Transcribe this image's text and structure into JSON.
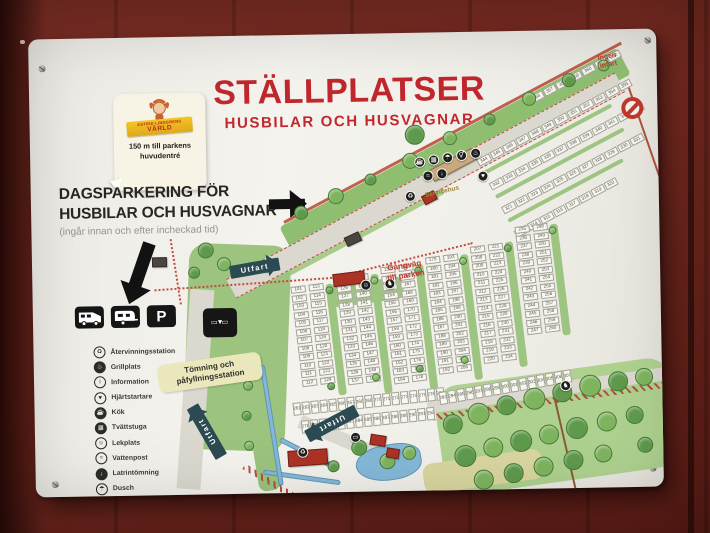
{
  "scene": {
    "setting": "white map sign mounted on red wooden wall"
  },
  "colors": {
    "wall": "#7a2b22",
    "board": "#f0efe9",
    "title_red": "#c1272d",
    "map_green": "#8fbe71",
    "lawn_green": "#9cc47e",
    "forest_green": "#aed18f",
    "tree_dark": "#5f9a4c",
    "tree_light": "#7fb45f",
    "road": "#dbd8cf",
    "teal_arrow": "#2c4a52",
    "label_yellow": "#ebe7bd",
    "path_red": "#c24b3f",
    "building_red": "#ad3326",
    "building_tan": "#c9a97e",
    "building_dark": "#4a453f",
    "water": "#85b8d8",
    "fence_brown": "#b05040"
  },
  "sign": {
    "title": "STÄLLPLATSER",
    "subtitle": "HUSBILAR OCH HUSVAGNAR",
    "badge": {
      "brand_line1": "ASTRID LINDGRENS",
      "brand_line2": "VÄRLD",
      "text_line1": "150 m till parkens",
      "text_line2": "huvudentré"
    },
    "day_parking": {
      "line1": "DAGSPARKERING FÖR",
      "line2": "HUSBILAR OCH HUSVAGNAR",
      "note": "(ingår innan och efter incheckad tid)"
    },
    "parking_letter": "P",
    "legend": [
      {
        "glyph": "♻",
        "label": "Återvinningsstation",
        "filled": false,
        "name": "recycling-icon"
      },
      {
        "glyph": "♨",
        "label": "Grillplats",
        "filled": true,
        "name": "grill-icon"
      },
      {
        "glyph": "i",
        "label": "Information",
        "filled": false,
        "name": "information-icon"
      },
      {
        "glyph": "♥",
        "label": "Hjärtstartare",
        "filled": false,
        "name": "defibrillator-icon"
      },
      {
        "glyph": "☕",
        "label": "Kök",
        "filled": true,
        "name": "kitchen-icon"
      },
      {
        "glyph": "▦",
        "label": "Tvättstuga",
        "filled": true,
        "name": "laundry-icon"
      },
      {
        "glyph": "☺",
        "label": "Lekplats",
        "filled": false,
        "name": "playground-icon"
      },
      {
        "glyph": "≈",
        "label": "Vattenpost",
        "filled": false,
        "name": "water-post-icon"
      },
      {
        "glyph": "↓",
        "label": "Latrintömning",
        "filled": true,
        "name": "latrine-icon"
      },
      {
        "glyph": "☂",
        "label": "Dusch",
        "filled": false,
        "name": "shower-icon"
      },
      {
        "glyph": "⚥",
        "label": "Toalett",
        "filled": false,
        "name": "toilet-icon"
      }
    ]
  },
  "map": {
    "labels": {
      "utfart": "Utfart",
      "no_entry": "Ingen\ninfart",
      "servicehus": "Servicehus",
      "gangvag": "Gångväg\ntill parken",
      "tomning": "Tömning och\npåfyllningsstation",
      "tomning_sign_row1": "▭ ▭",
      "tomning_sign_row2": "▼"
    },
    "greens": [
      {
        "x": 248,
        "y": 192,
        "w": 382,
        "h": 30,
        "rot": -27,
        "c": "#8fbe71",
        "rad": 4
      },
      {
        "x": 228,
        "y": 246,
        "w": 205,
        "h": 9,
        "rot": -27,
        "c": "#a9cc8d",
        "rad": 3
      },
      {
        "x": 158,
        "y": 206,
        "w": 102,
        "h": 206,
        "rot": 3,
        "c": "#9cc47e",
        "rad": 18
      },
      {
        "x": 298,
        "y": 252,
        "w": 72,
        "h": 22,
        "rot": -7,
        "c": "#9cc47e",
        "rad": 6
      },
      {
        "x": 398,
        "y": 356,
        "w": 238,
        "h": 110,
        "rot": -7,
        "c": "#aed18f",
        "rad": 24
      },
      {
        "x": 386,
        "y": 432,
        "w": 120,
        "h": 30,
        "rot": -7,
        "c": "#d9d6a0",
        "rad": 10
      },
      {
        "x": 206,
        "y": 330,
        "w": 22,
        "h": 128,
        "rot": -8,
        "c": "#9cc47e",
        "rad": 8
      }
    ],
    "roads": [
      {
        "x": 194,
        "y": 243,
        "w": 440,
        "h": 22,
        "rot": -27,
        "c": "#dbd8cf",
        "dashed": true
      },
      {
        "x": 158,
        "y": 252,
        "w": 24,
        "h": 200,
        "rot": 5,
        "c": "#dbd8cf",
        "dashed": false
      },
      {
        "x": 392,
        "y": 368,
        "w": 250,
        "h": 13,
        "rot": -7,
        "c": "#dbd8cf",
        "dashed": false
      },
      {
        "x": 268,
        "y": 380,
        "w": 90,
        "h": 14,
        "rot": 24,
        "c": "#dbd8cf",
        "dashed": false
      }
    ],
    "lines": [
      {
        "x": 252,
        "y": 186,
        "len": 382,
        "rot": -27,
        "h": 3,
        "c": "#c0604e"
      },
      {
        "x": 600,
        "y": 56,
        "len": 200,
        "rot": 72,
        "h": 2,
        "c": "#b05040"
      },
      {
        "x": 520,
        "y": 362,
        "len": 100,
        "rot": 78,
        "h": 2,
        "c": "#8a5a3a"
      }
    ],
    "fences": [
      {
        "x": 398,
        "y": 382,
        "len": 244,
        "rot": -7
      },
      {
        "x": 210,
        "y": 428,
        "len": 64,
        "rot": 32
      }
    ],
    "paths": [
      {
        "x": 122,
        "y": 252,
        "len": 186,
        "rot": -3
      },
      {
        "x": 312,
        "y": 240,
        "len": 132,
        "rot": -13
      },
      {
        "x": 140,
        "y": 202,
        "len": 66,
        "rot": 82
      }
    ],
    "water": [
      {
        "x": 318,
        "y": 416,
        "w": 66,
        "h": 36,
        "rot": -8,
        "rad": "50% 40% 45% 55%"
      },
      {
        "x": 246,
        "y": 402,
        "w": 66,
        "h": 5,
        "rot": 28,
        "rad": "3px"
      },
      {
        "x": 228,
        "y": 434,
        "w": 78,
        "h": 5,
        "rot": 9,
        "rad": "3px"
      },
      {
        "x": 226,
        "y": 330,
        "w": 5,
        "h": 122,
        "rot": -8,
        "rad": "3px"
      }
    ],
    "aisle_strips": [
      {
        "x": 293,
        "y": 250,
        "w": 8,
        "h": 112,
        "rot": -6
      },
      {
        "x": 338,
        "y": 241,
        "w": 8,
        "h": 120,
        "rot": -6
      },
      {
        "x": 383,
        "y": 232,
        "w": 8,
        "h": 126,
        "rot": -6
      },
      {
        "x": 428,
        "y": 223,
        "w": 8,
        "h": 126,
        "rot": -6
      },
      {
        "x": 473,
        "y": 211,
        "w": 8,
        "h": 126,
        "rot": -6
      },
      {
        "x": 518,
        "y": 194,
        "w": 8,
        "h": 112,
        "rot": -6
      },
      {
        "x": 452,
        "y": 140,
        "w": 145,
        "h": 3.5,
        "rot": -27
      },
      {
        "x": 464,
        "y": 164,
        "w": 145,
        "h": 3.5,
        "rot": -27
      },
      {
        "x": 476,
        "y": 188,
        "w": 130,
        "h": 3.5,
        "rot": -27
      }
    ],
    "parking_rows": [
      {
        "dir": "h",
        "x": 500,
        "y": 66,
        "w": 13.5,
        "h": 8,
        "gap": 1,
        "rot": -27,
        "count": 7,
        "start": 356
      },
      {
        "dir": "h",
        "x": 446,
        "y": 128,
        "w": 13.5,
        "h": 8,
        "gap": 1,
        "rot": -27,
        "count": 12,
        "start": 344
      },
      {
        "dir": "h",
        "x": 458,
        "y": 152,
        "w": 13.5,
        "h": 8,
        "gap": 1,
        "rot": -27,
        "count": 12,
        "start": 332
      },
      {
        "dir": "h",
        "x": 470,
        "y": 176,
        "w": 13.5,
        "h": 8,
        "gap": 1,
        "rot": -27,
        "count": 11,
        "start": 321
      },
      {
        "dir": "h",
        "x": 482,
        "y": 200,
        "w": 13.5,
        "h": 8,
        "gap": 1,
        "rot": -27,
        "count": 8,
        "start": 313
      },
      {
        "dir": "v",
        "x": 258,
        "y": 252,
        "w": 15,
        "h": 7.2,
        "gap": 1.3,
        "rot": -6,
        "count": 12,
        "start": 101
      },
      {
        "dir": "v",
        "x": 276,
        "y": 250,
        "w": 15,
        "h": 7.2,
        "gap": 1.3,
        "rot": -6,
        "count": 12,
        "start": 113
      },
      {
        "dir": "v",
        "x": 303,
        "y": 243,
        "w": 15,
        "h": 7.2,
        "gap": 1.3,
        "rot": -6,
        "count": 13,
        "start": 125
      },
      {
        "dir": "v",
        "x": 321,
        "y": 241,
        "w": 15,
        "h": 7.2,
        "gap": 1.3,
        "rot": -6,
        "count": 13,
        "start": 138
      },
      {
        "dir": "v",
        "x": 348,
        "y": 234,
        "w": 15,
        "h": 7.2,
        "gap": 1.3,
        "rot": -6,
        "count": 14,
        "start": 151
      },
      {
        "dir": "v",
        "x": 366,
        "y": 232,
        "w": 15,
        "h": 7.2,
        "gap": 1.3,
        "rot": -6,
        "count": 14,
        "start": 165
      },
      {
        "dir": "v",
        "x": 393,
        "y": 225,
        "w": 15,
        "h": 7.2,
        "gap": 1.3,
        "rot": -6,
        "count": 14,
        "start": 179
      },
      {
        "dir": "v",
        "x": 411,
        "y": 223,
        "w": 15,
        "h": 7.2,
        "gap": 1.3,
        "rot": -6,
        "count": 14,
        "start": 193
      },
      {
        "dir": "v",
        "x": 438,
        "y": 215,
        "w": 15,
        "h": 7.2,
        "gap": 1.3,
        "rot": -6,
        "count": 14,
        "start": 207
      },
      {
        "dir": "v",
        "x": 456,
        "y": 213,
        "w": 15,
        "h": 7.2,
        "gap": 1.3,
        "rot": -6,
        "count": 14,
        "start": 221
      },
      {
        "dir": "v",
        "x": 483,
        "y": 196,
        "w": 15,
        "h": 7.2,
        "gap": 1.3,
        "rot": -6,
        "count": 13,
        "start": 235
      },
      {
        "dir": "v",
        "x": 501,
        "y": 194,
        "w": 15,
        "h": 7.2,
        "gap": 1.3,
        "rot": -6,
        "count": 13,
        "start": 248
      },
      {
        "dir": "h",
        "x": 258,
        "y": 368,
        "w": 8,
        "h": 13,
        "gap": 1,
        "rot": -5,
        "count": 17,
        "start": 261
      },
      {
        "dir": "h",
        "x": 266,
        "y": 386,
        "w": 8,
        "h": 13,
        "gap": 1,
        "rot": -5,
        "count": 15,
        "start": 278
      },
      {
        "dir": "h",
        "x": 404,
        "y": 360,
        "w": 8,
        "h": 13,
        "gap": 1,
        "rot": -9,
        "count": 15,
        "start": 293
      }
    ],
    "trees": [
      [
        270,
        178,
        7
      ],
      [
        305,
        162,
        8
      ],
      [
        340,
        146,
        6
      ],
      [
        380,
        128,
        8
      ],
      [
        385,
        102,
        10
      ],
      [
        420,
        106,
        7
      ],
      [
        460,
        88,
        6
      ],
      [
        500,
        68,
        7
      ],
      [
        540,
        50,
        7
      ],
      [
        575,
        36,
        6
      ],
      [
        174,
        214,
        8
      ],
      [
        192,
        228,
        7
      ],
      [
        162,
        236,
        6
      ],
      [
        214,
        350,
        5
      ],
      [
        212,
        380,
        5
      ],
      [
        214,
        410,
        5
      ],
      [
        297,
        256,
        4
      ],
      [
        342,
        247,
        4
      ],
      [
        386,
        238,
        4
      ],
      [
        431,
        229,
        4
      ],
      [
        476,
        217,
        4
      ],
      [
        521,
        200,
        4
      ],
      [
        297,
        352,
        4
      ],
      [
        342,
        344,
        4
      ],
      [
        386,
        336,
        4
      ],
      [
        431,
        328,
        4
      ],
      [
        324,
        414,
        8
      ],
      [
        352,
        428,
        8
      ],
      [
        298,
        432,
        6
      ],
      [
        374,
        420,
        7
      ],
      [
        418,
        392,
        10
      ],
      [
        444,
        382,
        11
      ],
      [
        472,
        374,
        10
      ],
      [
        500,
        368,
        11
      ],
      [
        528,
        362,
        10
      ],
      [
        556,
        356,
        11
      ],
      [
        584,
        352,
        10
      ],
      [
        610,
        348,
        9
      ],
      [
        430,
        424,
        11
      ],
      [
        458,
        416,
        10
      ],
      [
        486,
        410,
        11
      ],
      [
        514,
        404,
        10
      ],
      [
        542,
        398,
        11
      ],
      [
        572,
        392,
        10
      ],
      [
        600,
        386,
        9
      ],
      [
        448,
        448,
        10
      ],
      [
        478,
        442,
        10
      ],
      [
        508,
        436,
        10
      ],
      [
        538,
        430,
        10
      ],
      [
        568,
        424,
        9
      ],
      [
        610,
        416,
        8
      ]
    ],
    "buildings": [
      {
        "x": 398,
        "y": 138,
        "w": 48,
        "h": 13,
        "rot": -27,
        "c": "tan",
        "n": "servicehus-building"
      },
      {
        "x": 390,
        "y": 164,
        "w": 14,
        "h": 10,
        "rot": -27,
        "c": "red",
        "n": "small-building"
      },
      {
        "x": 312,
        "y": 204,
        "w": 16,
        "h": 10,
        "rot": -24,
        "c": "dark",
        "n": "gate-building"
      },
      {
        "x": 300,
        "y": 240,
        "w": 32,
        "h": 13,
        "rot": -6,
        "c": "red",
        "n": "checkin-building"
      },
      {
        "x": 252,
        "y": 416,
        "w": 40,
        "h": 16,
        "rot": -3,
        "c": "red",
        "n": "barn-building"
      },
      {
        "x": 336,
        "y": 400,
        "w": 16,
        "h": 11,
        "rot": 10,
        "c": "red",
        "n": "shed-building"
      },
      {
        "x": 352,
        "y": 414,
        "w": 13,
        "h": 10,
        "rot": 10,
        "c": "red",
        "n": "shed-building"
      },
      {
        "x": 120,
        "y": 220,
        "w": 15,
        "h": 10,
        "rot": 0,
        "c": "dark",
        "n": "hut-building"
      }
    ],
    "icons": [
      {
        "x": 384,
        "y": 124,
        "g": "☕",
        "n": "kiosk-icon"
      },
      {
        "x": 398,
        "y": 122,
        "g": "▦",
        "n": "laundry-icon"
      },
      {
        "x": 412,
        "y": 120,
        "g": "☂",
        "n": "shower-icon"
      },
      {
        "x": 426,
        "y": 118,
        "g": "⚥",
        "n": "toilet-icon"
      },
      {
        "x": 440,
        "y": 116,
        "g": "♨",
        "n": "grill-icon"
      },
      {
        "x": 392,
        "y": 138,
        "g": "≈",
        "n": "water-post-icon"
      },
      {
        "x": 406,
        "y": 136,
        "g": "↓",
        "n": "latrine-icon"
      },
      {
        "x": 447,
        "y": 139,
        "g": "♥",
        "n": "defibrillator-icon"
      },
      {
        "x": 374,
        "y": 158,
        "g": "♻",
        "n": "recycling-icon"
      },
      {
        "x": 230,
        "y": 226,
        "g": "▭",
        "n": "vehicle-icon"
      },
      {
        "x": 328,
        "y": 246,
        "g": "☺",
        "n": "playground-icon"
      },
      {
        "x": 352,
        "y": 245,
        "g": "♞",
        "n": "animal-icon"
      },
      {
        "x": 315,
        "y": 398,
        "g": "▭",
        "n": "vehicle-icon"
      },
      {
        "x": 262,
        "y": 412,
        "g": "♻",
        "n": "recycling-icon"
      },
      {
        "x": 526,
        "y": 350,
        "g": "♞",
        "n": "horse-icon"
      }
    ]
  }
}
